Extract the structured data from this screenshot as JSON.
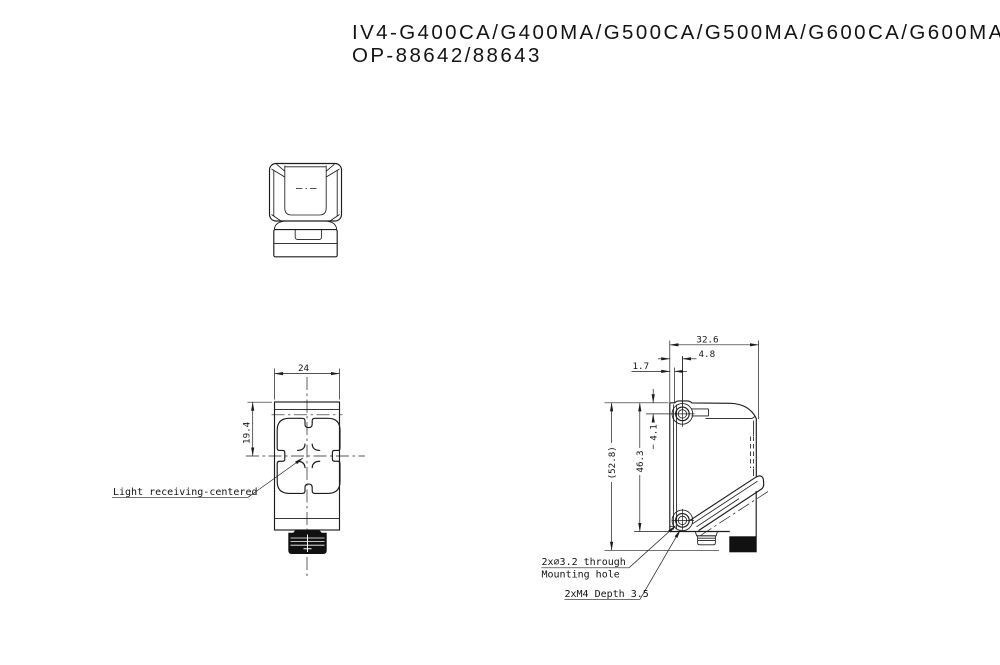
{
  "title": {
    "line1": "IV4-G400CA/G400MA/G500CA/G500MA/G600CA/G600MA",
    "line2": "OP-88642/88643"
  },
  "front_view": {
    "dim_width": "24",
    "dim_receiver_center": "19.4",
    "leader_label": "Light receiving-centered"
  },
  "side_view": {
    "dim_depth": "32.6",
    "dim_hole_center": "4.8",
    "dim_front_face": "1.7",
    "dim_hole_from_top": "4.1",
    "dim_body_height": "46.3",
    "dim_overall_height": "(52.8)",
    "leader_hole_line1": "2x⌀3.2 through",
    "leader_hole_line2": "Mounting hole",
    "leader_tap": "2xM4 Depth 3.5"
  },
  "colors": {
    "line": "#1c1c1c",
    "background": "#ffffff",
    "solid_fill": "#111111"
  }
}
